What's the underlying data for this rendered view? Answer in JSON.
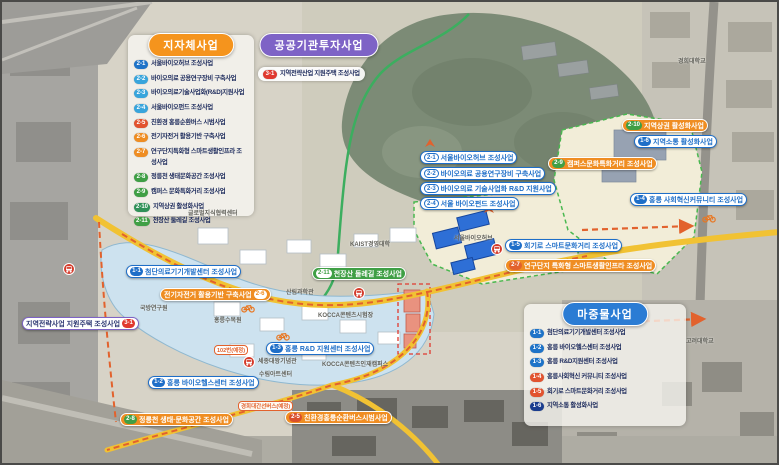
{
  "panels": {
    "local": {
      "title": "지자체사업",
      "header_color": "#f5941d",
      "items": [
        {
          "num": "2-1",
          "label": "서울바이오허브 조성사업",
          "color": "#1e73c8"
        },
        {
          "num": "2-2",
          "label": "바이오의료 공용연구장비 구축사업",
          "color": "#38a5dc"
        },
        {
          "num": "2-3",
          "label": "바이오의료기술사업화(R&D)지원사업",
          "color": "#38a5dc"
        },
        {
          "num": "2-4",
          "label": "서울바이오펀드 조성사업",
          "color": "#38a5dc"
        },
        {
          "num": "2-5",
          "label": "친환경 홍릉순환버스 시범사업",
          "color": "#e2532f"
        },
        {
          "num": "2-6",
          "label": "전기자전거 활용기반 구축사업",
          "color": "#ef8d22"
        },
        {
          "num": "2-7",
          "label": "연구단지특화형 스마트생활인프라 조성사업",
          "color": "#ef8d22",
          "wrap": true
        },
        {
          "num": "2-8",
          "label": "정릉천 생태문화공간 조성사업",
          "color": "#3f9f45"
        },
        {
          "num": "2-9",
          "label": "캠퍼스 문화특화거리 조성사업",
          "color": "#3f9f45"
        },
        {
          "num": "2-10",
          "label": "지역상권 활성화사업",
          "color": "#2f9158"
        },
        {
          "num": "2-11",
          "label": "천장산 둘레길 조성사업",
          "color": "#3f9f45"
        }
      ]
    },
    "public": {
      "title": "공공기관투자사업",
      "header_color": "#7e63c6",
      "items": [
        {
          "num": "3-1",
          "label": "지역전략산업 지원주택 조성사업",
          "color": "#e0392f"
        }
      ]
    },
    "priming": {
      "title": "마중물사업",
      "header_color": "#2b7cd4",
      "items": [
        {
          "num": "1-1",
          "label": "첨단의료기기개발센터 조성사업",
          "color": "#1e73c8"
        },
        {
          "num": "1-2",
          "label": "홍릉 바이오헬스센터 조성사업",
          "color": "#1e73c8"
        },
        {
          "num": "1-3",
          "label": "홍릉 R&D지원센터 조성사업",
          "color": "#1e73c8"
        },
        {
          "num": "1-4",
          "label": "홍릉사회혁신 커뮤니티 조성사업",
          "color": "#e2532f"
        },
        {
          "num": "1-5",
          "label": "회기로 스마트문화거리 조성사업",
          "color": "#e2532f"
        },
        {
          "num": "1-6",
          "label": "지역소통 활성화사업",
          "color": "#1a3d8f"
        }
      ]
    }
  },
  "map_labels": [
    {
      "num": "2-1",
      "text": "서울바이오허브 조성사업",
      "pill": "blue",
      "badge": "outline",
      "x": 418,
      "y": 149
    },
    {
      "num": "2-2",
      "text": "바이오의료 공용연구장비 구축사업",
      "pill": "blue",
      "badge": "outline",
      "x": 418,
      "y": 165
    },
    {
      "num": "2-3",
      "text": "바이오의료 기술사업화 R&D 지원사업",
      "pill": "blue",
      "badge": "outline",
      "x": 418,
      "y": 180
    },
    {
      "num": "2-4",
      "text": "서울 바이오펀드 조성사업",
      "pill": "blue",
      "badge": "outline",
      "x": 418,
      "y": 195
    },
    {
      "num": "1-1",
      "text": "첨단의료기기개발센터 조성사업",
      "pill": "blue",
      "x": 124,
      "y": 263
    },
    {
      "num": "2-6",
      "text": "전기자전거 활용기반 구축사업",
      "pill": "orange",
      "badge_bg": "#ffffff",
      "badge_fg": "#ef8d22",
      "side": "right",
      "x": 158,
      "y": 286
    },
    {
      "num": "3-1",
      "text": "지역전략사업 지원주택 조성사업",
      "pill": "purple",
      "badge_bg": "#e0392f",
      "side": "right",
      "x": 20,
      "y": 315
    },
    {
      "num": "1-3",
      "text": "홍릉 R&D 지원센터 조성사업",
      "pill": "blue",
      "x": 264,
      "y": 340
    },
    {
      "num": "1-2",
      "text": "홍릉 바이오헬스센터 조성사업",
      "pill": "blue",
      "x": 146,
      "y": 374
    },
    {
      "num": "2-8",
      "text": "정릉천 생태·문화공간 조성사업",
      "pill": "orange",
      "badge_bg": "#3f9f45",
      "x": 118,
      "y": 411
    },
    {
      "num": "2-5",
      "text": "친환경홍릉순환버스시범사업",
      "pill": "orange",
      "badge_bg": "#d94f2b",
      "x": 283,
      "y": 409
    },
    {
      "num": "2-11",
      "text": "천장산 둘레길 조성사업",
      "pill": "green",
      "badge_bg": "#ffffff",
      "badge_fg": "#3f9f45",
      "x": 310,
      "y": 265
    },
    {
      "num": "2-9",
      "text": "캠퍼스문화특화거리 조성사업",
      "pill": "orange",
      "badge_bg": "#3f9f45",
      "x": 546,
      "y": 155
    },
    {
      "num": "2-10",
      "text": "지역상권 활성화사업",
      "pill": "orange",
      "badge_bg": "#3f9f45",
      "x": 620,
      "y": 117
    },
    {
      "num": "1-6",
      "text": "지역소통 활성화사업",
      "pill": "blue",
      "x": 632,
      "y": 133
    },
    {
      "num": "1-4",
      "text": "홍릉 사회혁신커뮤니티 조성사업",
      "pill": "blue",
      "x": 628,
      "y": 191
    },
    {
      "num": "1-5",
      "text": "회기로 스마트문화거리 조성사업",
      "pill": "blue",
      "x": 503,
      "y": 237
    },
    {
      "num": "2-7",
      "text": "연구단지 특화형 스마트생활인프라 조성사업",
      "pill": "orange",
      "badge_bg": "#e2622d",
      "x": 503,
      "y": 257
    }
  ],
  "map_pois": [
    {
      "text": "경희대학교",
      "x": 676,
      "y": 54
    },
    {
      "text": "고려대학교",
      "x": 684,
      "y": 334
    },
    {
      "text": "KAIST경영대학",
      "x": 348,
      "y": 237
    },
    {
      "text": "서울바이오허브",
      "x": 452,
      "y": 231
    },
    {
      "text": "산림과학관",
      "x": 284,
      "y": 285
    },
    {
      "text": "국방연구원",
      "x": 138,
      "y": 301
    },
    {
      "text": "홍릉수목원",
      "x": 212,
      "y": 313
    },
    {
      "text": "KOCCA콘텐츠시험장",
      "x": 316,
      "y": 308
    },
    {
      "text": "세종대왕기념관",
      "x": 256,
      "y": 354
    },
    {
      "text": "KOCCA콘텐츠인재캠퍼스",
      "x": 320,
      "y": 357
    },
    {
      "text": "수림아트센터",
      "x": 257,
      "y": 367
    },
    {
      "text": "글로벌지식협력센터",
      "x": 186,
      "y": 206
    }
  ],
  "road_tags": [
    {
      "text": "102번(예정)",
      "x": 212,
      "y": 343
    },
    {
      "text": "경희대간선버스(예정)",
      "x": 236,
      "y": 399
    }
  ],
  "icons": {
    "bus_stops": [
      [
        67,
        267
      ],
      [
        357,
        291
      ],
      [
        247,
        360
      ],
      [
        495,
        247
      ]
    ],
    "bicycles": [
      [
        246,
        306
      ],
      [
        281,
        334
      ],
      [
        707,
        216
      ]
    ],
    "route_arrows": [
      [
        428,
        143
      ],
      [
        487,
        209
      ]
    ]
  },
  "colors": {
    "local_header": "#f5941d",
    "public_header": "#7e63c6",
    "priming_header": "#2b7cd4",
    "blue_project": "#1e6ec8",
    "orange_project": "#ef8d22",
    "green_project": "#3f9f45",
    "red_badge": "#e0392f",
    "yellow_road": "#f1c233",
    "bus_route": "#e2622d",
    "trail_green": "#3cae5f"
  }
}
